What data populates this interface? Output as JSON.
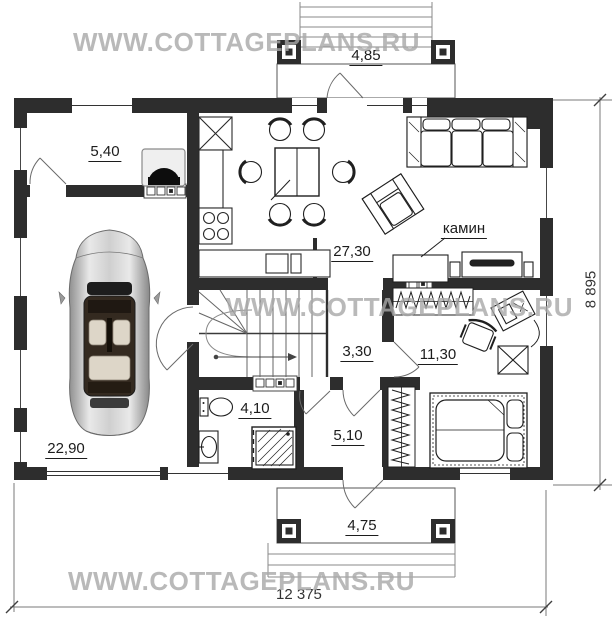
{
  "watermark": {
    "text": "WWW.COTTAGEPLANS.RU"
  },
  "plan": {
    "rooms": {
      "boiler_room": "5,40",
      "garage": "22,90",
      "kitchen_living_room": "27,30",
      "hallway": "3,30",
      "bedroom": "11,30",
      "bathroom": "4,10",
      "entry_hall": "5,10"
    },
    "annotations": {
      "fireplace": "камин"
    },
    "dimensions": {
      "top_porch_width": "4,85",
      "bottom_porch_width": "4,75",
      "overall_width": "12 375",
      "overall_depth": "8 895"
    }
  },
  "colors": {
    "wall": "#2d2d2d",
    "watermark": "#a8a8a8",
    "line": "#444444"
  }
}
